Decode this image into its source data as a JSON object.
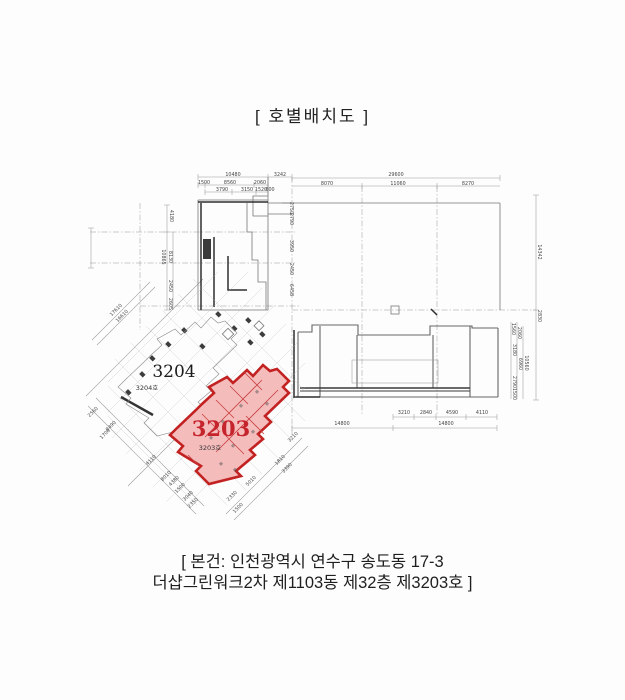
{
  "title": "[ 호별배치도 ]",
  "caption": {
    "line1": "[ 본건: 인천광역시 연수구 송도동 17-3",
    "line2": "더샵그린워크2차 제1103동 제32층 제3203호 ]"
  },
  "colors": {
    "paper": "#fdfdfd",
    "ink": "#222222",
    "line_light": "#9a9a9a",
    "line_dark": "#2e2e2e",
    "highlight_fill": "#f5bcbc",
    "highlight_stroke": "#c22222",
    "highlight_text": "#c5242c"
  },
  "units": [
    {
      "id": "3204",
      "label": "3204",
      "ho_label": "3204호",
      "highlighted": false
    },
    {
      "id": "3203",
      "label": "3203",
      "ho_label": "3203호",
      "highlighted": true
    }
  ],
  "unit_labels": [
    {
      "t": "3204",
      "x": 174,
      "y": 377,
      "cls": "unit-big",
      "name": "unit-3204-label"
    },
    {
      "t": "3204호",
      "x": 147,
      "y": 390,
      "cls": "unit-small",
      "name": "unit-3204-ho-label"
    },
    {
      "t": "3203",
      "x": 221,
      "y": 436,
      "cls": "unit-big-red",
      "name": "unit-3203-label",
      "color": "highlight_text"
    },
    {
      "t": "3203호",
      "x": 210,
      "y": 450,
      "cls": "unit-small",
      "name": "unit-3203-ho-label"
    }
  ],
  "dim_labels": [
    {
      "t": "10480",
      "x": 233,
      "y": 176,
      "r": 0
    },
    {
      "t": "3242",
      "x": 280,
      "y": 176,
      "r": 0
    },
    {
      "t": "1500",
      "x": 204,
      "y": 184,
      "r": 0
    },
    {
      "t": "8560",
      "x": 230,
      "y": 184,
      "r": 0
    },
    {
      "t": "2060",
      "x": 260,
      "y": 184,
      "r": 0
    },
    {
      "t": "3790",
      "x": 222,
      "y": 191,
      "r": 0
    },
    {
      "t": "3150",
      "x": 247,
      "y": 191,
      "r": 0
    },
    {
      "t": "1520",
      "x": 261,
      "y": 191,
      "r": 0
    },
    {
      "t": "600",
      "x": 270,
      "y": 191,
      "r": 0
    },
    {
      "t": "29600",
      "x": 396,
      "y": 176,
      "r": 0
    },
    {
      "t": "8070",
      "x": 327,
      "y": 185,
      "r": 0
    },
    {
      "t": "11060",
      "x": 398,
      "y": 185,
      "r": 0
    },
    {
      "t": "8270",
      "x": 468,
      "y": 185,
      "r": 0
    },
    {
      "t": "14342",
      "x": 538,
      "y": 252,
      "r": 90
    },
    {
      "t": "2830",
      "x": 538,
      "y": 316,
      "r": 90
    },
    {
      "t": "1560",
      "x": 512,
      "y": 329,
      "r": 90
    },
    {
      "t": "2060",
      "x": 518,
      "y": 333,
      "r": 90
    },
    {
      "t": "3180",
      "x": 513,
      "y": 350,
      "r": 90
    },
    {
      "t": "6960",
      "x": 519,
      "y": 364,
      "r": 90
    },
    {
      "t": "10560",
      "x": 525,
      "y": 363,
      "r": 90
    },
    {
      "t": "2790",
      "x": 513,
      "y": 382,
      "r": 90
    },
    {
      "t": "1500",
      "x": 513,
      "y": 394,
      "r": 90
    },
    {
      "t": "4180",
      "x": 170,
      "y": 216,
      "r": 90
    },
    {
      "t": "10865",
      "x": 162,
      "y": 257,
      "r": 90
    },
    {
      "t": "8130",
      "x": 169,
      "y": 257,
      "r": 90
    },
    {
      "t": "2450",
      "x": 169,
      "y": 286,
      "r": 90
    },
    {
      "t": "2605",
      "x": 169,
      "y": 304,
      "r": 90
    },
    {
      "t": "2750",
      "x": 290,
      "y": 208,
      "r": 90
    },
    {
      "t": "2790",
      "x": 290,
      "y": 219,
      "r": 90
    },
    {
      "t": "3950",
      "x": 290,
      "y": 246,
      "r": 90
    },
    {
      "t": "2450",
      "x": 290,
      "y": 269,
      "r": 90
    },
    {
      "t": "6458",
      "x": 290,
      "y": 290,
      "r": 90
    },
    {
      "t": "3210",
      "x": 404,
      "y": 414,
      "r": 0
    },
    {
      "t": "2840",
      "x": 426,
      "y": 414,
      "r": 0
    },
    {
      "t": "4590",
      "x": 452,
      "y": 414,
      "r": 0
    },
    {
      "t": "4110",
      "x": 482,
      "y": 414,
      "r": 0
    },
    {
      "t": "14800",
      "x": 342,
      "y": 425,
      "r": 0
    },
    {
      "t": "14800",
      "x": 446,
      "y": 425,
      "r": 0
    },
    {
      "t": "17610",
      "x": 117,
      "y": 311,
      "r": -45
    },
    {
      "t": "16610",
      "x": 123,
      "y": 317,
      "r": -45
    },
    {
      "t": "2560",
      "x": 94,
      "y": 413,
      "r": -45
    },
    {
      "t": "8490",
      "x": 112,
      "y": 427,
      "r": -45
    },
    {
      "t": "1700",
      "x": 106,
      "y": 435,
      "r": -45
    },
    {
      "t": "4110",
      "x": 152,
      "y": 461,
      "r": -45
    },
    {
      "t": "8010",
      "x": 167,
      "y": 477,
      "r": -45
    },
    {
      "t": "4380",
      "x": 175,
      "y": 482,
      "r": -45
    },
    {
      "t": "1500",
      "x": 181,
      "y": 489,
      "r": -45
    },
    {
      "t": "3040",
      "x": 189,
      "y": 497,
      "r": -45
    },
    {
      "t": "2350",
      "x": 194,
      "y": 504,
      "r": -45
    },
    {
      "t": "2330",
      "x": 233,
      "y": 497,
      "r": -45
    },
    {
      "t": "1500",
      "x": 239,
      "y": 509,
      "r": -45
    },
    {
      "t": "5010",
      "x": 252,
      "y": 482,
      "r": -45
    },
    {
      "t": "1810",
      "x": 281,
      "y": 461,
      "r": -45
    },
    {
      "t": "3390",
      "x": 288,
      "y": 469,
      "r": -45
    },
    {
      "t": "3210",
      "x": 294,
      "y": 438,
      "r": -45
    }
  ]
}
